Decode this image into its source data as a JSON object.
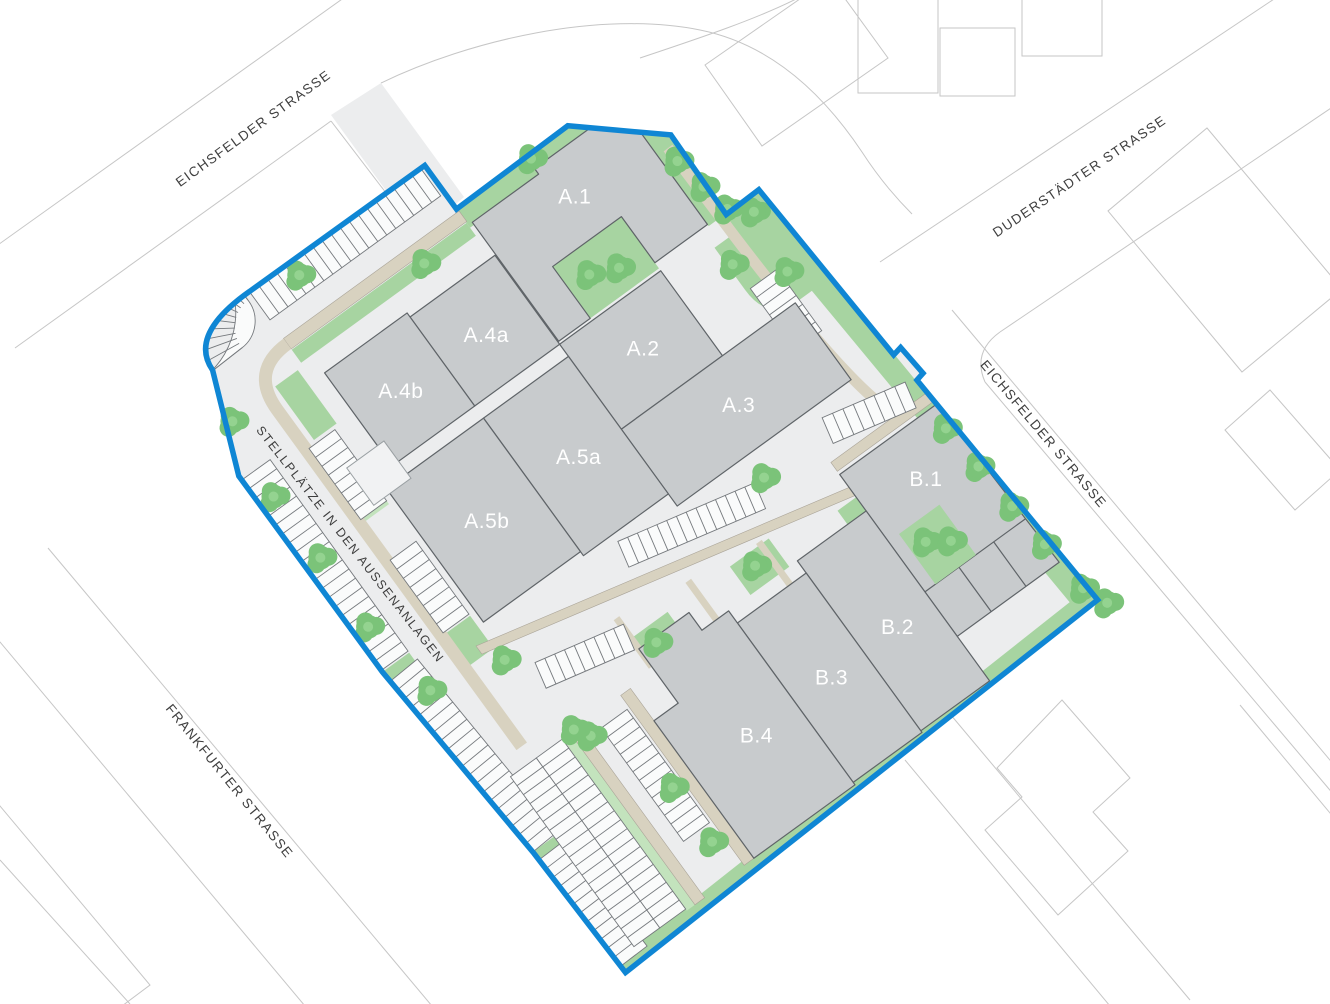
{
  "plan": {
    "title": "Wohnquartier Lageplan",
    "boundary_color": "#0f86d4",
    "building_color": "#c8cbcd",
    "building_outline_color": "#5f6468",
    "green_color": "#a7d4a1",
    "tree_color": "#7bc379",
    "path_color": "#d8d2c0",
    "ground_color": "#ecedee",
    "parking_stall_color": "#fafbfb"
  },
  "streets": [
    {
      "id": "eichsfelder-nw",
      "label": "EICHSFELDER STRASSE"
    },
    {
      "id": "duderstaedter",
      "label": "DUDERSTÄDTER STRASSE"
    },
    {
      "id": "eichsfelder-e",
      "label": "EICHSFELDER STRASSE"
    },
    {
      "id": "frankfurter",
      "label": "FRANKFURTER STRASSE"
    }
  ],
  "note": {
    "label": "STELLPLÄTZE IN DEN AUSSENANLAGEN"
  },
  "buildings": [
    {
      "id": "a1",
      "label": "A.1"
    },
    {
      "id": "a2",
      "label": "A.2"
    },
    {
      "id": "a3",
      "label": "A.3"
    },
    {
      "id": "a4a",
      "label": "A.4a"
    },
    {
      "id": "a4b",
      "label": "A.4b"
    },
    {
      "id": "a5a",
      "label": "A.5a"
    },
    {
      "id": "a5b",
      "label": "A.5b"
    },
    {
      "id": "b1",
      "label": "B.1"
    },
    {
      "id": "b2",
      "label": "B.2"
    },
    {
      "id": "b3",
      "label": "B.3"
    },
    {
      "id": "b4",
      "label": "B.4"
    }
  ]
}
